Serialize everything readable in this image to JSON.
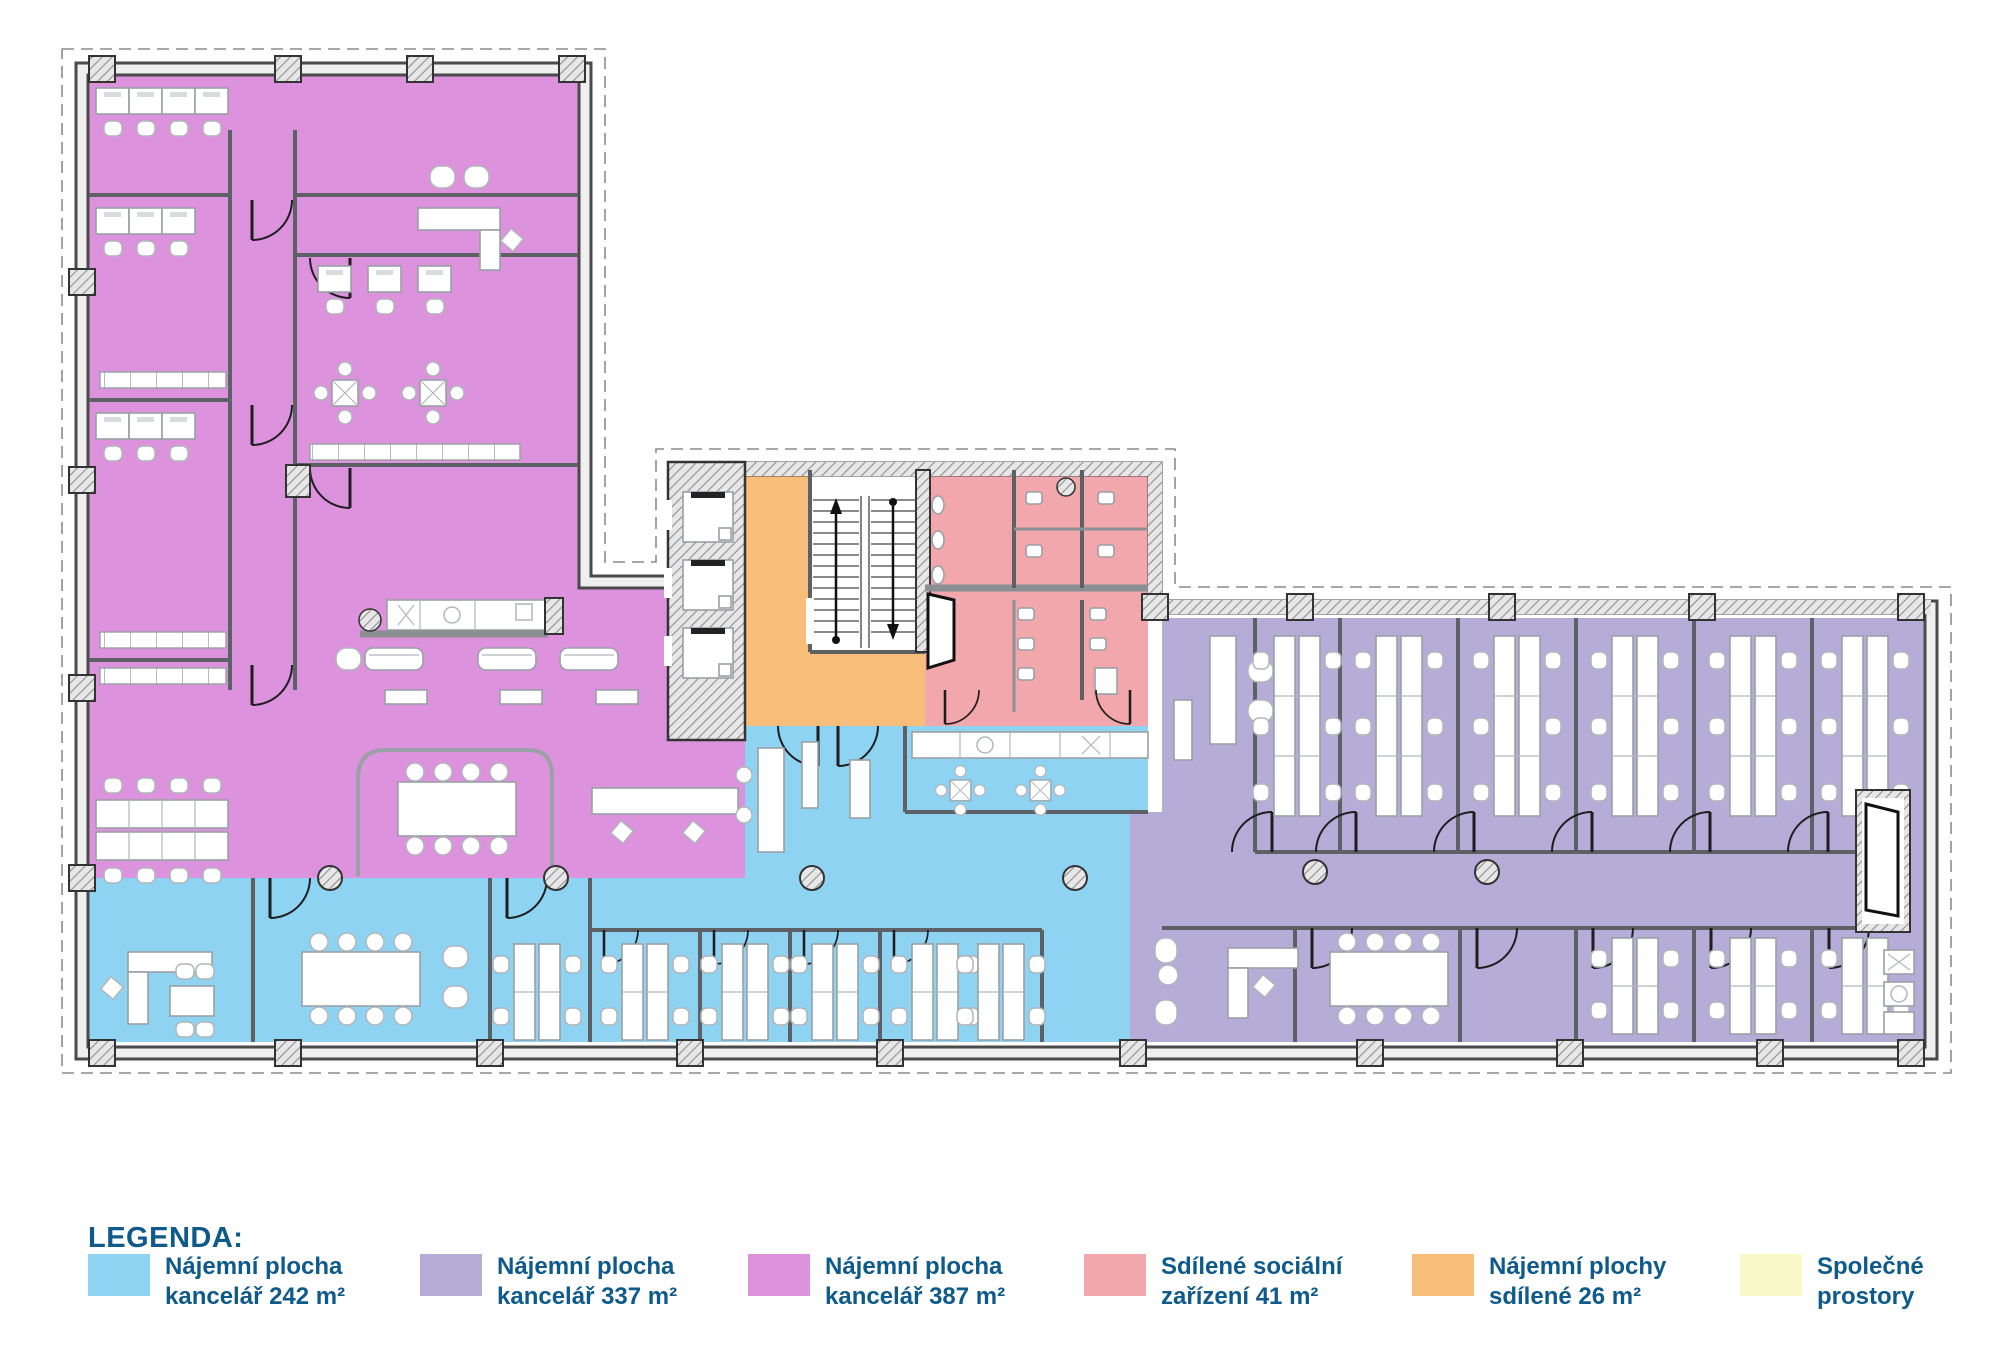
{
  "colors": {
    "blue": "#8fd3f2",
    "lavender": "#b5acd8",
    "magenta": "#dd92de",
    "pink": "#f2a7ad",
    "orange": "#f8be79",
    "yellow": "#fafac8",
    "text": "#0e5a8a"
  },
  "legend": {
    "title": "LEGENDA:",
    "items": [
      {
        "line1": "Nájemní plocha",
        "line2": "kancelář 242 m²",
        "color": "#8fd3f2"
      },
      {
        "line1": "Nájemní plocha",
        "line2": "kancelář 337 m²",
        "color": "#b5acd8"
      },
      {
        "line1": "Nájemní plocha",
        "line2": "kancelář 387 m²",
        "color": "#dd92de"
      },
      {
        "line1": "Sdílené sociální",
        "line2": "zařízení 41 m²",
        "color": "#f2a7ad"
      },
      {
        "line1": "Nájemní plochy",
        "line2": "sdílené 26 m²",
        "color": "#f8be79"
      },
      {
        "line1": "Společné",
        "line2": "prostory",
        "color": "#fafac8"
      }
    ]
  }
}
